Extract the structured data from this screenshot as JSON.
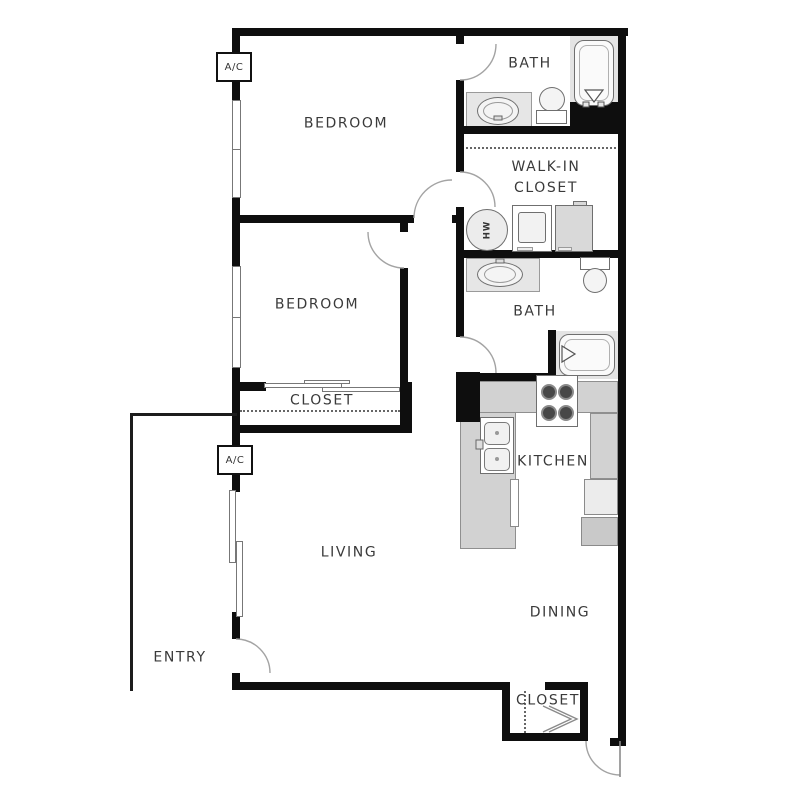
{
  "page": {
    "type": "apartment-floor-plan",
    "background": "#ffffff"
  },
  "colors": {
    "wall": "#0e0e0e",
    "kitchen_counter": "#d2d2d2",
    "bath_counter": "#e6e6e6",
    "appliance_gray": "#d9d9d9",
    "fixture_outline": "#6f6f6f",
    "door_arc": "#a3a3a3",
    "label_text": "#3a3a3a"
  },
  "labels": {
    "bedroom1": "BEDROOM",
    "bath1": "BATH",
    "walkin_closet": "WALK-IN\nCLOSET",
    "bedroom2": "BEDROOM",
    "bedroom2_closet": "CLOSET",
    "bath2": "BATH",
    "kitchen": "KITCHEN",
    "living": "LIVING",
    "dining": "DINING",
    "entry": "ENTRY",
    "entry_closet": "CLOSET",
    "ac_unit_top": "A/C",
    "ac_unit_living": "A/C",
    "water_heater": "HW"
  }
}
